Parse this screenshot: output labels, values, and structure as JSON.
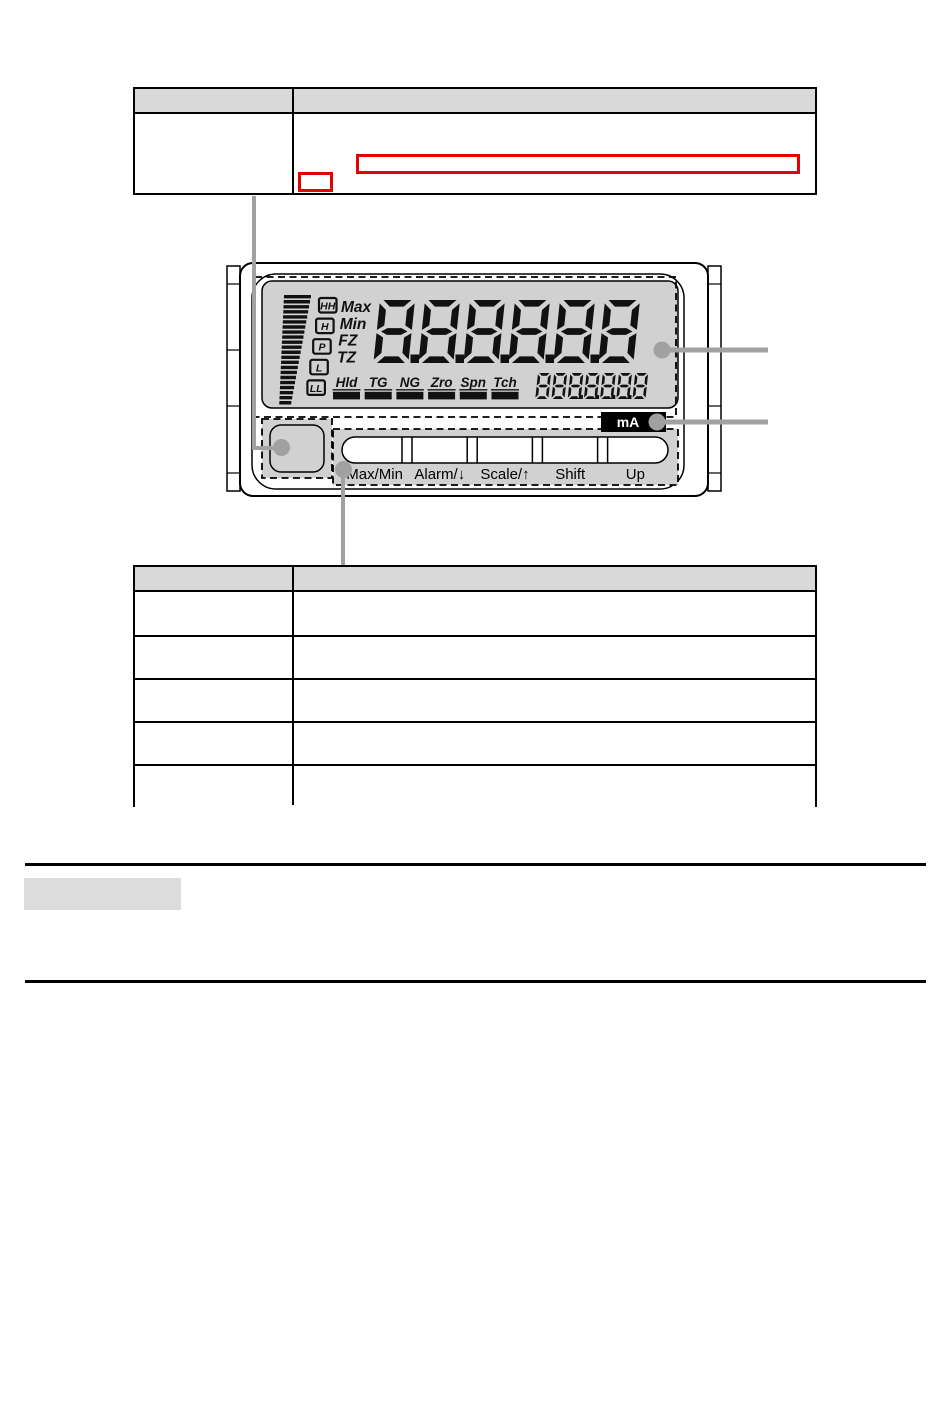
{
  "meter": {
    "main_display": "8.8.8.8.8.8",
    "aux_display": "888.8.8.8.8",
    "unit_label": "mA",
    "bargraph_segments": 22,
    "setpoint_indicators": [
      "HH",
      "H",
      "P",
      "L",
      "LL"
    ],
    "mode_indicators": [
      "Max",
      "Min",
      "FZ",
      "TZ"
    ],
    "status_indicators": [
      "Hld",
      "TG",
      "NG",
      "Zro",
      "Spn",
      "Tch"
    ],
    "buttons": [
      "Max/Min",
      "Alarm/↓",
      "Scale/↑",
      "Shift",
      "Up"
    ]
  },
  "tables": {
    "top": {
      "header": [
        "",
        ""
      ],
      "rows": [
        [
          "",
          ""
        ]
      ]
    },
    "bottom": {
      "header": [
        "",
        ""
      ],
      "rows": [
        [
          "",
          ""
        ],
        [
          "",
          ""
        ],
        [
          "",
          ""
        ],
        [
          "",
          ""
        ],
        [
          "",
          ""
        ]
      ]
    }
  },
  "colors": {
    "annotation_red": "#e60000",
    "callout_gray": "#a1a1a1",
    "lcd_gray": "#d1d1d1",
    "table_header_gray": "#d9d9d9",
    "section_box_gray": "#dcdcdc",
    "segment_black": "#111111",
    "unit_tag_bg": "#000000",
    "unit_tag_text": "#ffffff"
  }
}
